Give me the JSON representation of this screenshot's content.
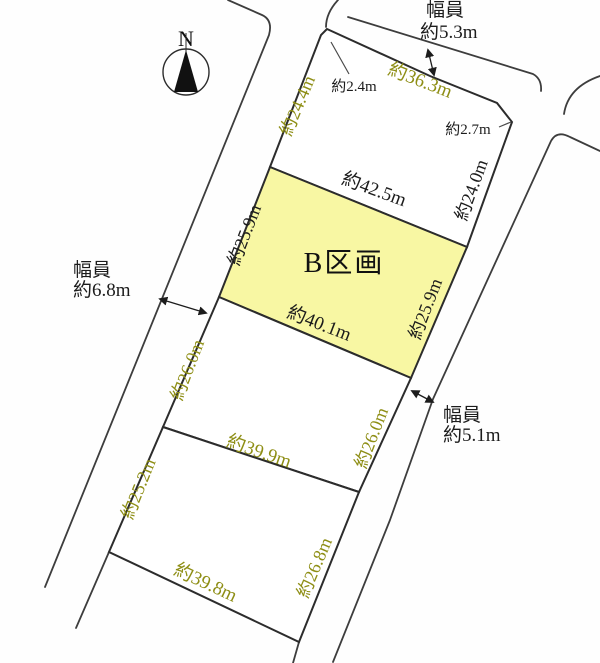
{
  "compass": {
    "north_label": "N"
  },
  "roads": {
    "top": {
      "width_title": "幅員",
      "width_value": "約5.3m"
    },
    "left": {
      "width_title": "幅員",
      "width_value": "約6.8m"
    },
    "right": {
      "width_title": "幅員",
      "width_value": "約5.1m"
    }
  },
  "parcels": {
    "north": {
      "edge_top": "約36.3m",
      "edge_left": "約24.4m",
      "edge_right": "約24.0m",
      "corner_cut_left": "約2.4m",
      "corner_cut_right": "約2.7m"
    },
    "b": {
      "name": "B区画",
      "edge_top": "約42.5m",
      "edge_left": "約25.9m",
      "edge_right": "約25.9m",
      "edge_bottom": "約40.1m"
    },
    "middle": {
      "edge_left": "約26.0m",
      "edge_right": "約26.0m",
      "edge_bottom": "約39.9m"
    },
    "south": {
      "edge_left": "約25.2m",
      "edge_right": "約26.8m",
      "edge_bottom": "約39.8m"
    }
  },
  "colors": {
    "highlight_fill": "#f8f7a3",
    "other_parcel_dim_text": "#8e8e15",
    "primary_text": "#1c1c1c",
    "line": "#3d3d3d"
  }
}
